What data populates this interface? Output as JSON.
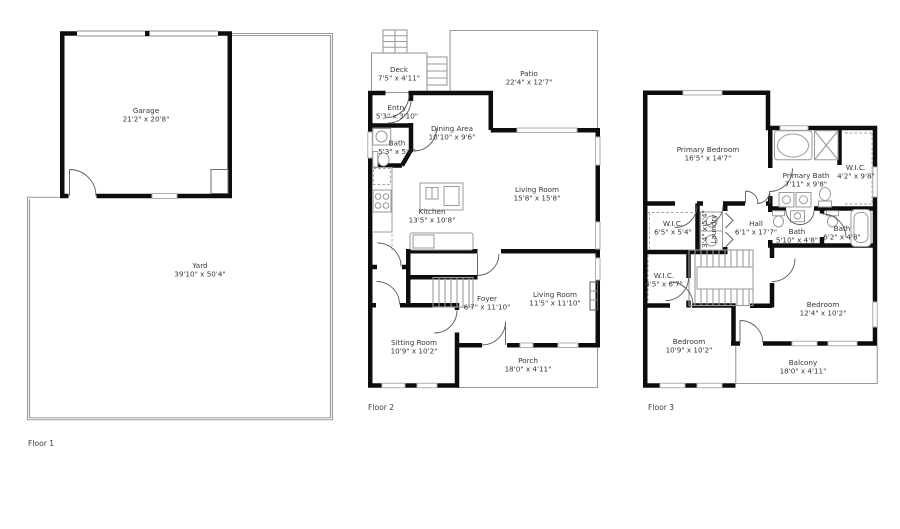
{
  "document": {
    "type": "floor-plan"
  },
  "colors": {
    "wall": "#0d0d0d",
    "window": "#aeaeae",
    "outline": "#9a9a9a",
    "text": "#353535"
  },
  "floors": [
    {
      "label": "Floor 1",
      "rooms": [
        {
          "name": "Garage",
          "dims": "21'2\" x 20'8\""
        },
        {
          "name": "Yard",
          "dims": "39'10\" x 50'4\""
        }
      ]
    },
    {
      "label": "Floor 2",
      "rooms": [
        {
          "name": "Deck",
          "dims": "7'5\" x 4'11\""
        },
        {
          "name": "Patio",
          "dims": "22'4\" x 12'7\""
        },
        {
          "name": "Entry",
          "dims": "5'3\" x 3'10\""
        },
        {
          "name": "Bath",
          "dims": "5'3\" x 5'0\""
        },
        {
          "name": "Dining Area",
          "dims": "10'10\" x 9'6\""
        },
        {
          "name": "Kitchen",
          "dims": "13'5\" x 10'8\""
        },
        {
          "name": "Living Room",
          "dims": "15'8\" x 15'8\""
        },
        {
          "name": "Foyer",
          "dims": "6'7\" x 11'10\""
        },
        {
          "name": "Living Room",
          "dims": "11'5\" x 11'10\""
        },
        {
          "name": "Sitting Room",
          "dims": "10'9\" x 10'2\""
        },
        {
          "name": "Porch",
          "dims": "18'0\" x 4'11\""
        }
      ]
    },
    {
      "label": "Floor 3",
      "rooms": [
        {
          "name": "Primary Bedroom",
          "dims": "16'5\" x 14'7\""
        },
        {
          "name": "Primary Bath",
          "dims": "7'11\" x 9'8\""
        },
        {
          "name": "W.I.C.",
          "dims": "4'2\" x 9'8\""
        },
        {
          "name": "W.I.C.",
          "dims": "6'5\" x 5'4\""
        },
        {
          "name": "Laundry",
          "dims": "3'4\" x 5'4\""
        },
        {
          "name": "Hall",
          "dims": "6'1\" x 17'7\""
        },
        {
          "name": "Bath",
          "dims": "5'10\" x 4'8\""
        },
        {
          "name": "Bath",
          "dims": "6'2\" x 4'8\""
        },
        {
          "name": "W.I.C.",
          "dims": "4'5\" x 6'7\""
        },
        {
          "name": "Bedroom",
          "dims": "12'4\" x 10'2\""
        },
        {
          "name": "Bedroom",
          "dims": "10'9\" x 10'2\""
        },
        {
          "name": "Balcony",
          "dims": "18'0\" x 4'11\""
        }
      ]
    }
  ]
}
